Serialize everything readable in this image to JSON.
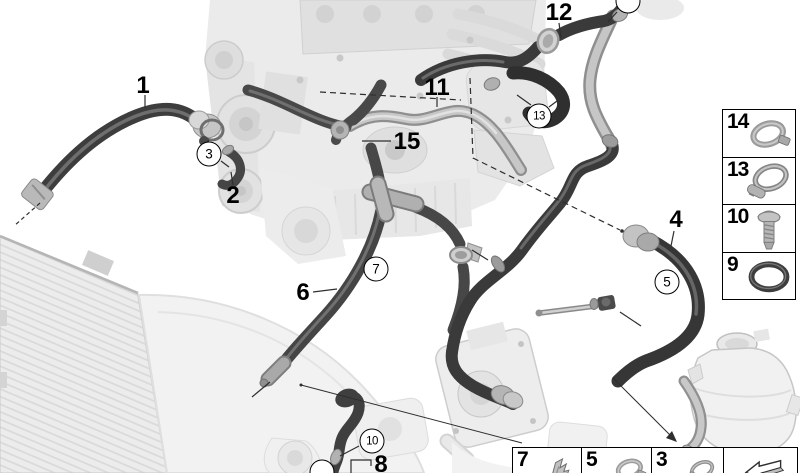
{
  "diagram": {
    "title": "engine-cooling-system-hoses-parts-diagram",
    "callout_labels": [
      {
        "text": "1",
        "x": 143,
        "y": 86
      },
      {
        "text": "2",
        "x": 233,
        "y": 196
      },
      {
        "text": "4",
        "x": 676,
        "y": 220
      },
      {
        "text": "6",
        "x": 303,
        "y": 293
      },
      {
        "text": "8",
        "x": 381,
        "y": 465
      },
      {
        "text": "11",
        "x": 437,
        "y": 88
      },
      {
        "text": "12",
        "x": 559,
        "y": 13
      },
      {
        "text": "15",
        "x": 407,
        "y": 142
      }
    ],
    "circled_callouts": [
      {
        "text": "3",
        "x": 209,
        "y": 154
      },
      {
        "text": "5",
        "x": 667,
        "y": 282
      },
      {
        "text": "7",
        "x": 376,
        "y": 269
      },
      {
        "text": "10",
        "x": 372,
        "y": 441
      },
      {
        "text": "13",
        "x": 539,
        "y": 116
      }
    ],
    "partial_circles": [
      {
        "x": 628,
        "y": 1
      },
      {
        "x": 322,
        "y": 472
      }
    ],
    "side_legend": [
      {
        "number": "14",
        "icon": "hose-clamp-icon"
      },
      {
        "number": "13",
        "icon": "screw-clamp-icon"
      },
      {
        "number": "10",
        "icon": "bolt-icon"
      },
      {
        "number": "9",
        "icon": "o-ring-icon"
      }
    ],
    "bottom_legend": [
      {
        "number": "7",
        "icon": "retaining-clip-icon"
      },
      {
        "number": "5",
        "icon": "hose-clamp-icon"
      },
      {
        "number": "3",
        "icon": "small-clamp-icon"
      },
      {
        "number": "",
        "icon": "continue-arrow-icon"
      }
    ],
    "colors": {
      "background": "#ffffff",
      "callout_line": "#000000",
      "hose_dark": "#3c3c3c",
      "hose_light": "#c0c0c0",
      "watermark": "#e9e9e9"
    }
  }
}
